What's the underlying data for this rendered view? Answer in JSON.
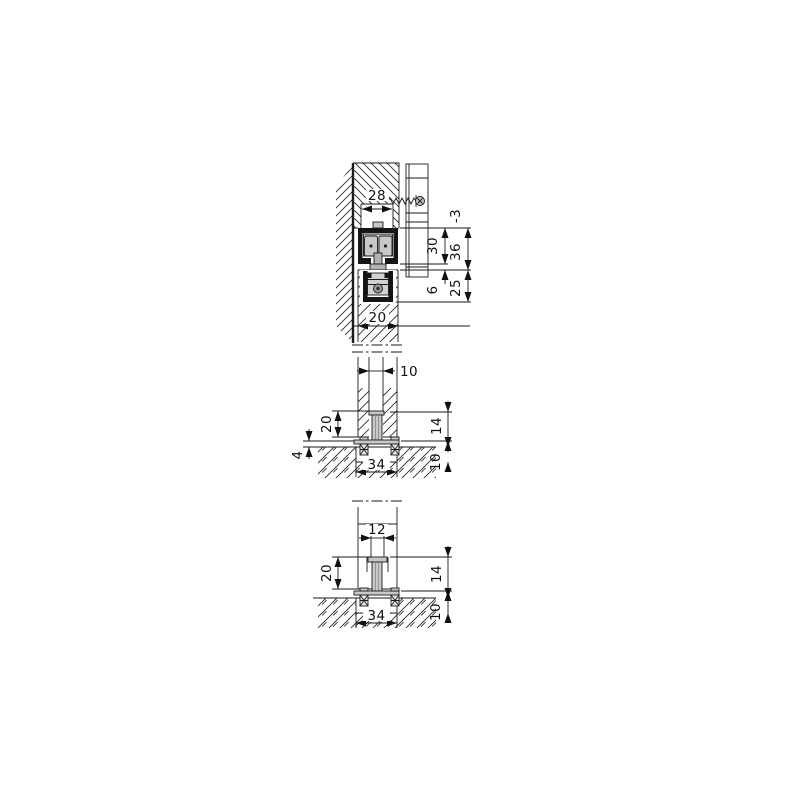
{
  "drawing_type": "sliding-door-fitting-cross-section",
  "colors": {
    "background": "#ffffff",
    "line": "#1a1a1a",
    "profile_black": "#151515",
    "part_gray": "#c8c8c8"
  },
  "dims": {
    "v1": {
      "d28": "28",
      "d30": "30",
      "d6": "6",
      "d36": "36",
      "d36tol": "-3",
      "d25": "25",
      "d20": "20"
    },
    "v2": {
      "d10_groove": "10",
      "d20_depth": "20",
      "d4_gap": "4",
      "d14_guide": "14",
      "d10_floor": "10",
      "d34_plate": "34"
    },
    "v3": {
      "d12_groove": "12",
      "d20_depth": "20",
      "d14_guide": "14",
      "d10_floor": "10",
      "d34_plate": "34"
    }
  }
}
